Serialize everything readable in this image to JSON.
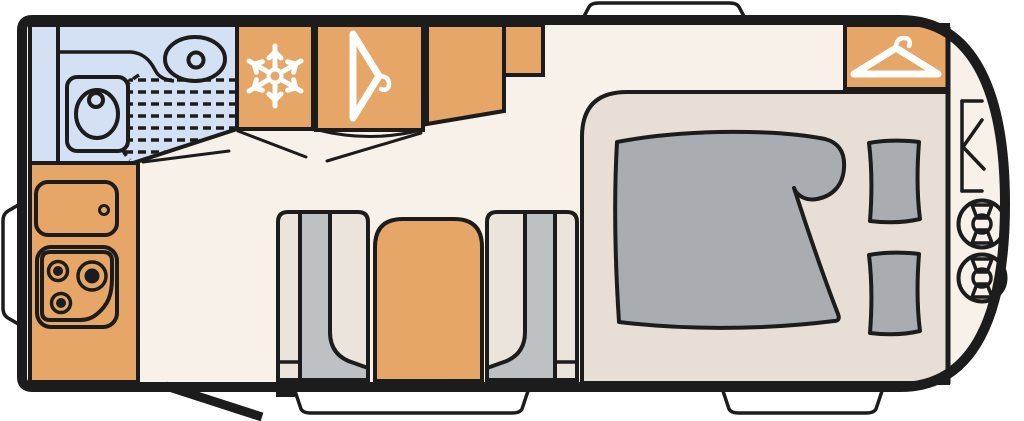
{
  "diagram": {
    "kind": "caravan-floorplan",
    "colors": {
      "outline": "#1c1c1c",
      "floor": "#f8f1ea",
      "bathroom": "#d4e0f3",
      "cabinet": "#e6a667",
      "platform": "#e7dfd6",
      "seat": "#eae4dd",
      "seat_back": "#bdc1c4",
      "bedding": "#a9adb1",
      "window": "#ffffff",
      "icon": "#ffffff"
    },
    "icons": {
      "fridge": "snowflake-icon",
      "mid_wardrobe": "hanger-icon",
      "front_wardrobe": "hanger-icon",
      "gas_locker": "gas-bottle-icon",
      "hob": "three-burner-hob-icon",
      "toilet": "toilet-icon",
      "washbasin": "washbasin-icon"
    }
  }
}
